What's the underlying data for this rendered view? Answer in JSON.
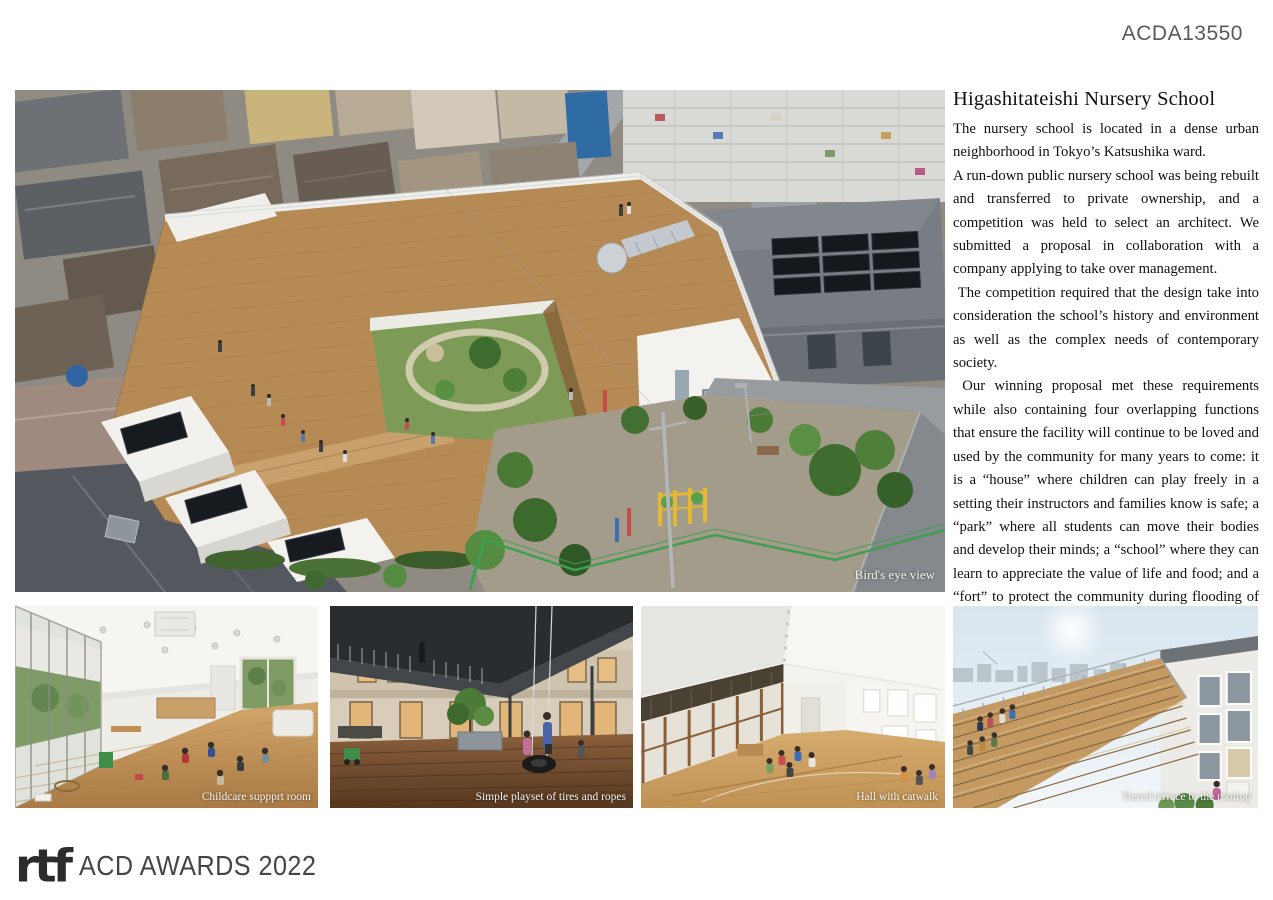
{
  "page": {
    "id_label": "ACDA13550"
  },
  "article": {
    "title": "Higashitateishi Nursery School",
    "paragraphs": [
      "The nursery school is located in a dense urban neighborhood in Tokyo’s Katsushika ward.",
      "A run-down public nursery school was being rebuilt and transferred to private ownership, and a competition was held to select an architect. We submitted a proposal in collaboration with a company applying to take over management.",
      " The competition required that the design take into consideration the school’s history and environment as well as the complex needs of contemporary society.",
      " Our winning proposal met these requirements while also containing four overlapping functions that ensure the facility will continue to be loved and used by the community for many years to come: it is a “house” where children can play freely in a setting their instructors and families know is safe; a “park” where all students can move their bodies and develop their minds; a “school” where they can learn to appreciate the value of life and food; and a “fort” to protect the community during flooding of the nearby raised-bed river and other disasters."
    ]
  },
  "photos": {
    "main": {
      "caption": "Bird's eye view"
    },
    "bottom": [
      {
        "caption": "Childcare suppprt room"
      },
      {
        "caption": "Simple playset of tires and ropes"
      },
      {
        "caption": "Hall with catwalk"
      },
      {
        "caption": "Tiered terrace to the rooftop"
      }
    ]
  },
  "footer": {
    "logo_mark": "rtf",
    "logo_text": "ACD AWARDS 2022"
  },
  "colors": {
    "page_bg": "#ffffff",
    "body_text": "#101010",
    "doc_id": "#58595c",
    "caption": "#f4f2ec",
    "logo_mark": "#2c2c2e",
    "awards_text": "#454548",
    "deck_wood": "#b68a55",
    "courtyard_green": "#7d9b57",
    "fence_green": "#3f9e4f"
  }
}
